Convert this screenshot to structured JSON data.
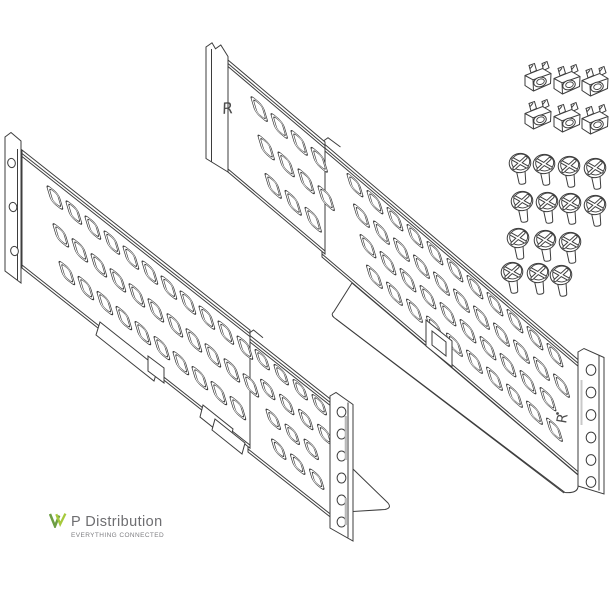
{
  "illustration": {
    "left_end_marking": "R",
    "right_end_marking": "R",
    "line_color": "#3d3d3d",
    "marking_color": "#4d4d4d",
    "hardware": {
      "cage_nut_count": 6,
      "screw_count": 14
    }
  },
  "logo": {
    "name": "P Distribution",
    "tagline": "EVERYTHING CONNECTED",
    "name_color": "#6e6e71",
    "tagline_color": "#7e7e82",
    "mark_dark_green": "#6d9e43",
    "mark_light_green": "#a6c93c"
  }
}
